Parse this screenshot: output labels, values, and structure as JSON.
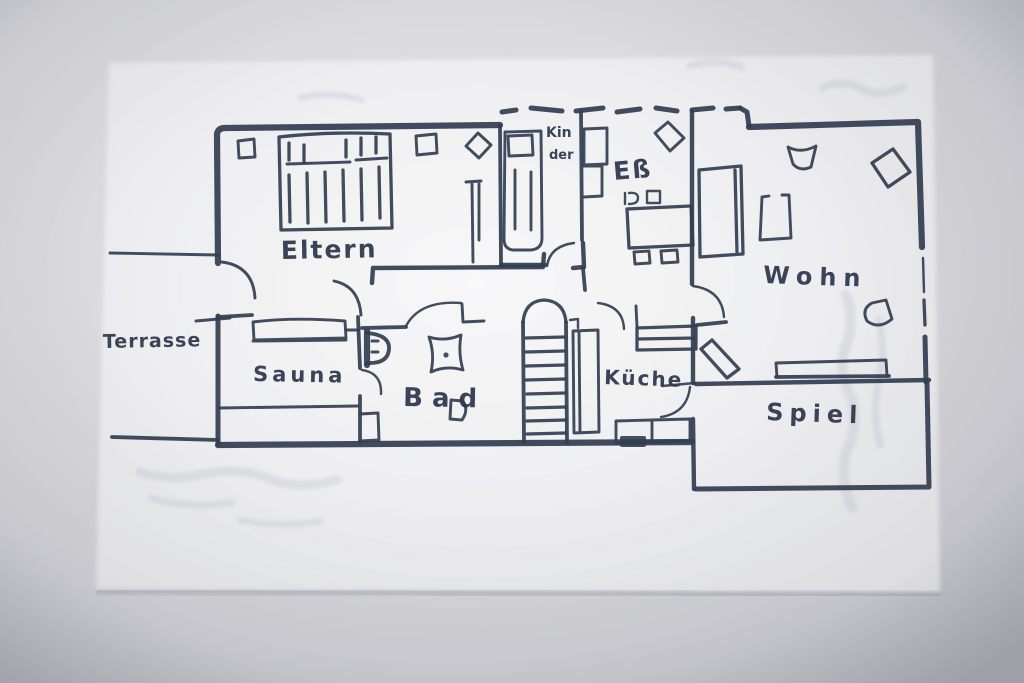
{
  "figure_type": "hand-drawn-floor-plan-photo",
  "floor_plan": {
    "rooms": [
      {
        "id": "eltern",
        "label": "Eltern"
      },
      {
        "id": "ess",
        "label": "Eß"
      },
      {
        "id": "wohn",
        "label": "Wohn"
      },
      {
        "id": "spiel",
        "label": "Spiel"
      },
      {
        "id": "kueche",
        "label": "Küche"
      },
      {
        "id": "bad",
        "label": "Bad"
      },
      {
        "id": "sauna",
        "label": "Sauna"
      },
      {
        "id": "terrasse",
        "label": "Terrasse"
      },
      {
        "id": "kinder",
        "label_line1": "Kin",
        "label_line2": "der"
      }
    ],
    "colors": {
      "ink": "#333e52",
      "paper": "#f5f5f7",
      "backdrop": "#d3d3d7"
    }
  }
}
